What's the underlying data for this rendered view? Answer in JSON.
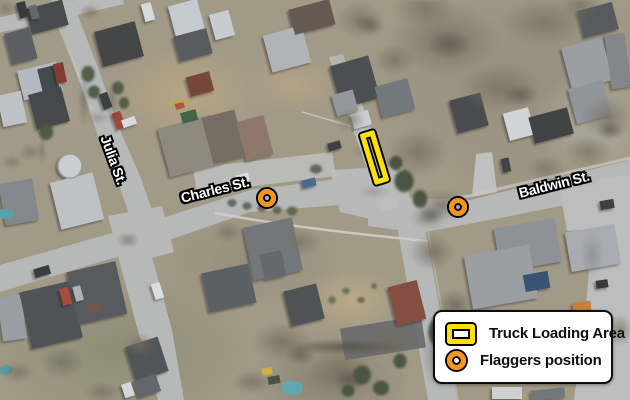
{
  "map": {
    "streets": [
      {
        "id": "julia",
        "name": "Julia St."
      },
      {
        "id": "charles",
        "name": "Charles St."
      },
      {
        "id": "baldwin",
        "name": "Baldwin St."
      }
    ],
    "annotation_colors": {
      "truck_loading_area_yellow": "#ffe000",
      "flagger_orange": "#f7941d",
      "outline_black": "#000000"
    }
  },
  "legend": {
    "items": [
      {
        "icon": "truck-loading-area-swatch",
        "label": "Truck Loading Area"
      },
      {
        "icon": "flagger-position-swatch",
        "label": "Flaggers position"
      }
    ]
  }
}
